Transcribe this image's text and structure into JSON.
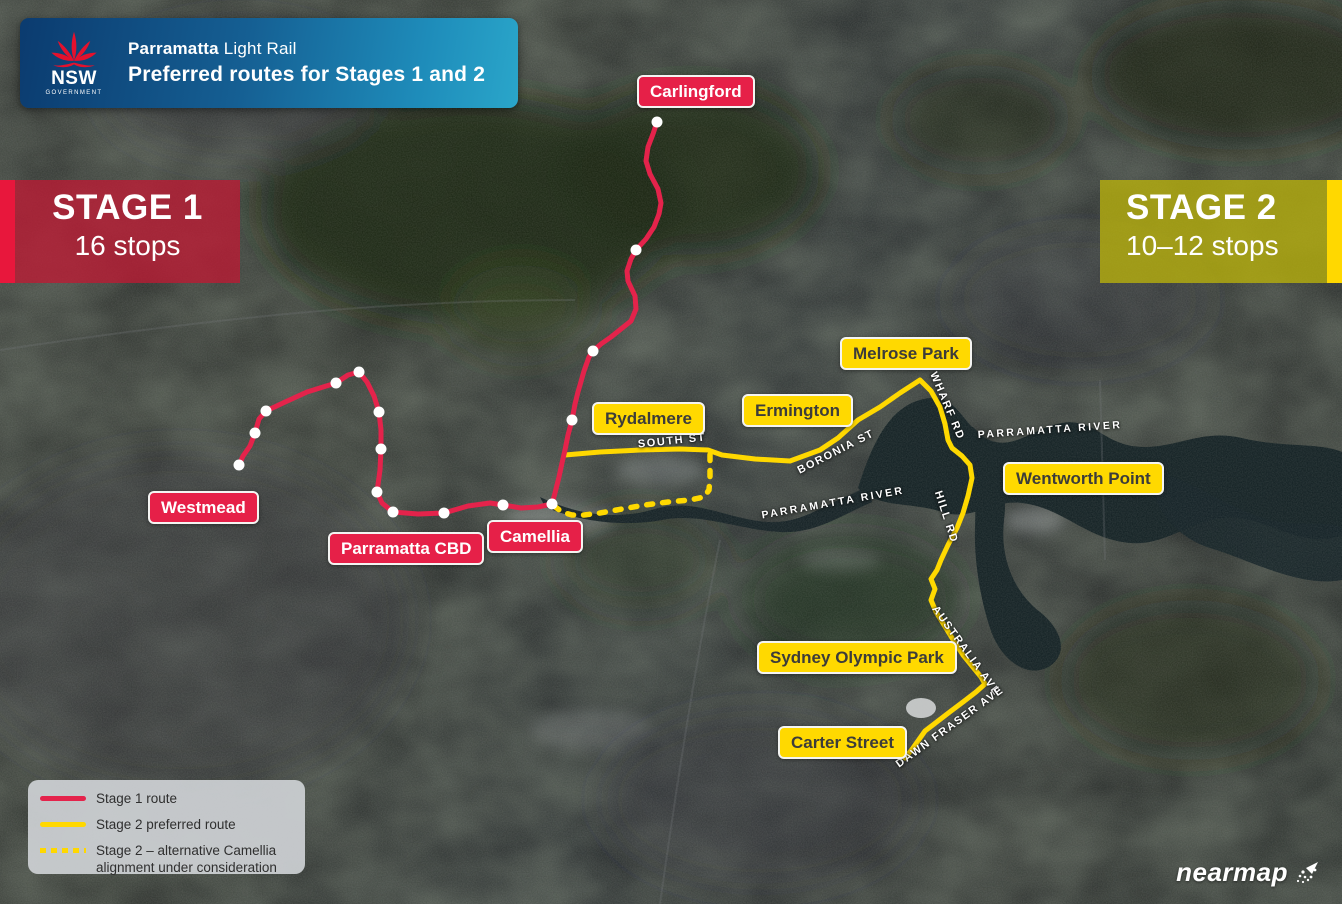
{
  "banner": {
    "logo": {
      "org": "NSW",
      "org_sub": "GOVERNMENT"
    },
    "title_bold": "Parramatta",
    "title_regular": " Light Rail",
    "subtitle": "Preferred routes for Stages 1 and 2"
  },
  "badges": {
    "stage1": {
      "title": "STAGE 1",
      "subtitle": "16 stops"
    },
    "stage2": {
      "title": "STAGE 2",
      "subtitle": "10–12 stops"
    }
  },
  "stations": {
    "stage1": [
      "Carlingford",
      "Westmead",
      "Parramatta CBD",
      "Camellia"
    ],
    "stage2": [
      "Rydalmere",
      "Ermington",
      "Melrose Park",
      "Wentworth Point",
      "Sydney Olympic Park",
      "Carter Street"
    ]
  },
  "streets": {
    "south_st": "SOUTH ST",
    "boronia_st": "BORONIA ST",
    "wharf_rd": "WHARF RD",
    "parramatta_river_west": "PARRAMATTA RIVER",
    "parramatta_river_east": "PARRAMATTA RIVER",
    "hill_rd": "HILL RD",
    "australia_ave": "AUSTRALIA AVE",
    "dawn_fraser_ave": "DAWN FRASER AVE"
  },
  "legend": {
    "items": [
      {
        "label": "Stage 1 route",
        "style": "solid",
        "color": "#e4234b"
      },
      {
        "label": "Stage 2 preferred route",
        "style": "solid",
        "color": "#ffd800"
      },
      {
        "label": "Stage 2 – alternative Camellia alignment under consideration",
        "style": "dashed",
        "color": "#ffd800"
      }
    ]
  },
  "watermark": "nearmap",
  "colors": {
    "stage1_red": "#e4234b",
    "stage2_yellow": "#ffd800",
    "banner_blue_dark": "#0b3b6f",
    "banner_blue_light": "#2aa6ca",
    "label_text_dark": "#3c3c3a"
  }
}
